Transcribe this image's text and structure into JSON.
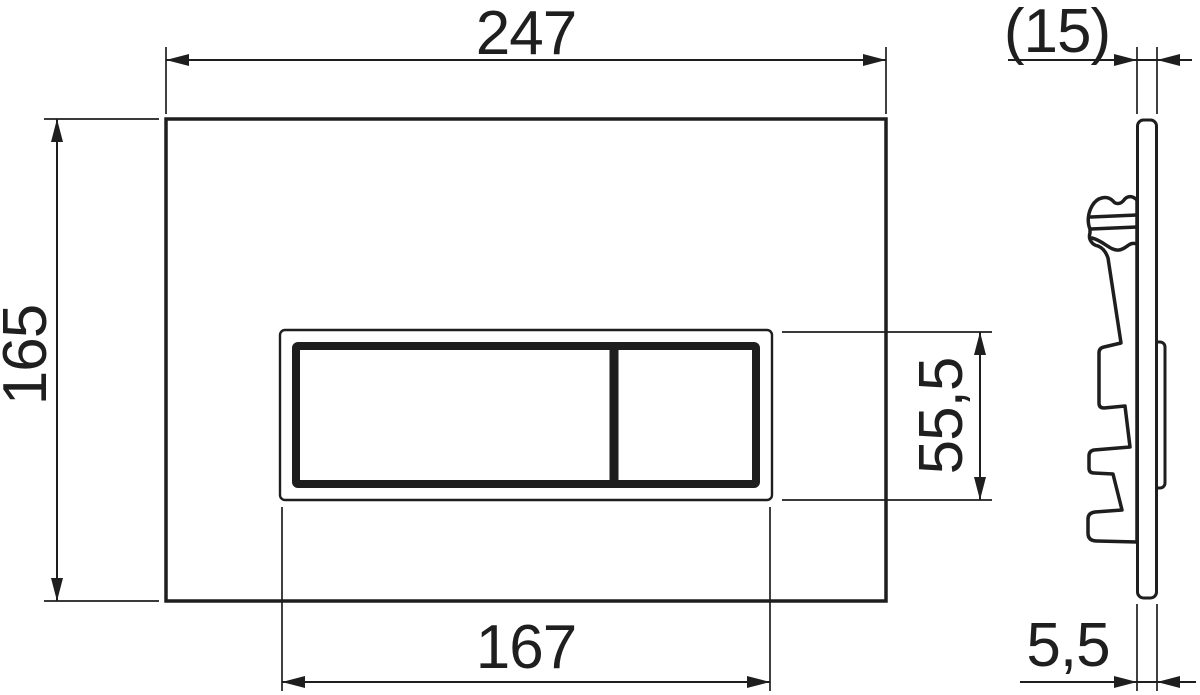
{
  "colors": {
    "bg": "#ffffff",
    "line": "#1e1e1e",
    "text": "#1f1f1f",
    "face": "#ffffff"
  },
  "dimension_labels": {
    "plate_width": "247",
    "plate_height": "165",
    "button_cutout_width": "167",
    "button_cutout_height": "55,5",
    "total_depth": "(15)",
    "plate_thickness": "5,5"
  }
}
